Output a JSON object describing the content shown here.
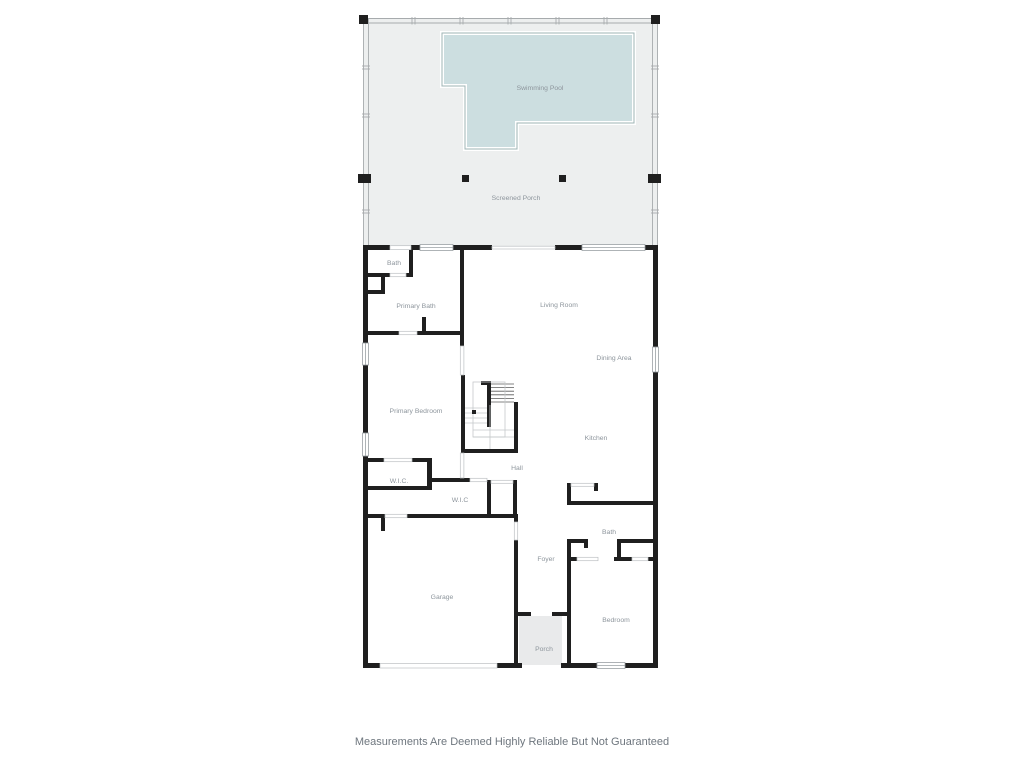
{
  "labels": {
    "swimming_pool": "Swimming Pool",
    "screened_porch": "Screened Porch",
    "bath_upper": "Bath",
    "primary_bath": "Primary Bath",
    "living_room": "Living Room",
    "dining_area": "Dining Area",
    "primary_bedroom": "Primary Bedroom",
    "kitchen": "Kitchen",
    "hall": "Hall",
    "wic_left": "W.I.C.",
    "wic_mid": "W.I.C",
    "bath_lower": "Bath",
    "foyer": "Foyer",
    "garage": "Garage",
    "bedroom": "Bedroom",
    "porch": "Porch"
  },
  "footer": {
    "disclaimer": "Measurements Are Deemed Highly Reliable But Not Guaranteed"
  },
  "colors": {
    "wall": "#1f1f1f",
    "porch_fill": "#edefef",
    "entry_porch_fill": "#e9eaeb",
    "pool_fill": "#ccdee0",
    "pool_stroke": "#9fb4b6",
    "room_label": "#8d959c",
    "disclaimer_text": "#6e767e"
  }
}
